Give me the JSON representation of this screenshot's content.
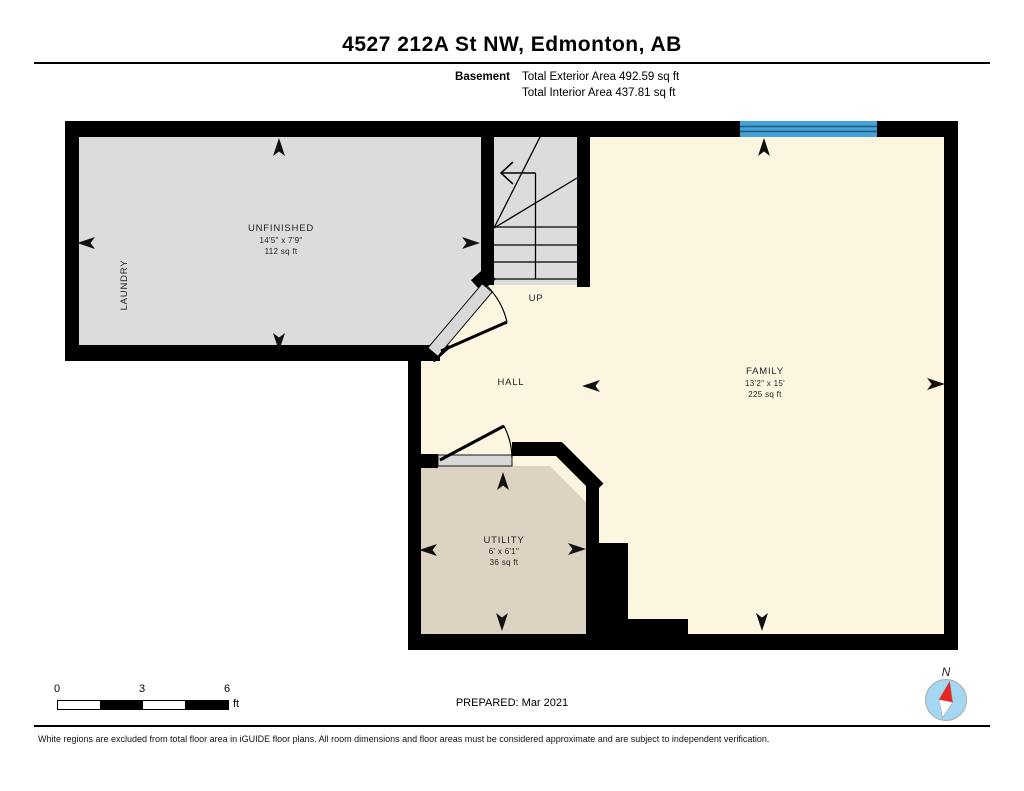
{
  "header": {
    "title": "4527 212A St NW, Edmonton, AB",
    "floor_label": "Basement",
    "exterior_area": "Total Exterior Area 492.59 sq ft",
    "interior_area": "Total Interior Area 437.81 sq ft"
  },
  "rooms": {
    "unfinished": {
      "name": "UNFINISHED",
      "dims": "14'5\" x 7'9\"",
      "area": "112 sq ft"
    },
    "laundry": {
      "name": "LAUNDRY"
    },
    "family": {
      "name": "FAMILY",
      "dims": "13'2\" x 15'",
      "area": "225 sq ft"
    },
    "utility": {
      "name": "UTILITY",
      "dims": "6' x 6'1\"",
      "area": "36 sq ft"
    },
    "hall": {
      "name": "HALL"
    },
    "stairs": {
      "up_label": "UP"
    }
  },
  "scale_bar": {
    "labels": [
      "0",
      "3",
      "6"
    ],
    "unit": "ft"
  },
  "compass": {
    "label": "N"
  },
  "footer": {
    "prepared": "PREPARED: Mar 2021",
    "disclaimer": "White regions are excluded from total floor area in iGUIDE floor plans. All room dimensions and floor areas must be considered approximate and are subject to independent verification."
  },
  "colors": {
    "wall": "#000000",
    "room_gray": "#dcdcdc",
    "room_cream": "#fcf5e0",
    "room_tan": "#ddd3c2",
    "window_blue": "#45a1d7",
    "window_line": "#1d5b7d",
    "door_sill": "#d8d8d8",
    "compass_blue": "#a6d7f2",
    "compass_red": "#e8251f"
  }
}
